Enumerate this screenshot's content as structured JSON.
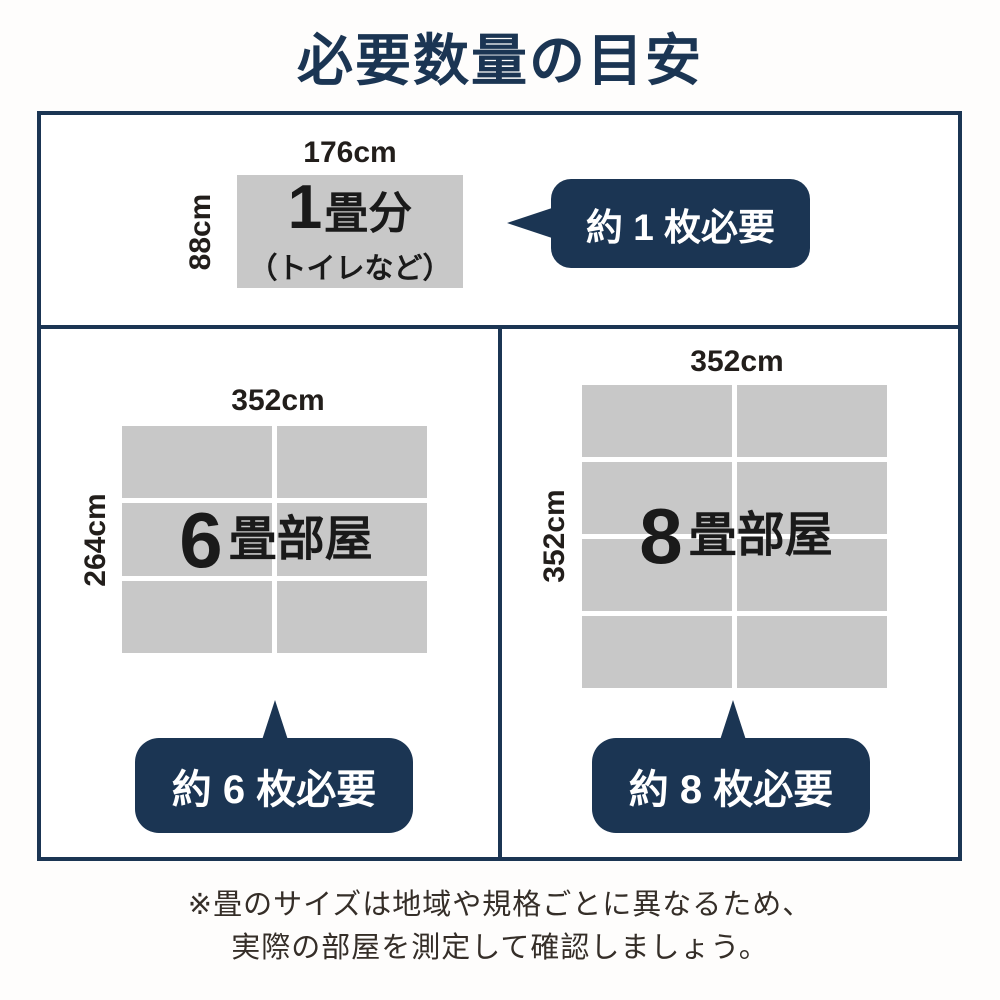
{
  "title": "必要数量の目安",
  "colors": {
    "navy": "#1b3553",
    "tatami_gray": "#c8c8c8",
    "text_dark": "#1a1a1a",
    "footnote_text": "#352e28"
  },
  "one_tatami": {
    "top_dim": "176cm",
    "side_dim": "88cm",
    "big_num": "1",
    "suffix": "畳分",
    "sub_label": "（トイレなど）",
    "bubble": "約 1 枚必要"
  },
  "six_tatami": {
    "top_dim": "352cm",
    "side_dim": "264cm",
    "big_num": "6",
    "suffix": "畳部屋",
    "bubble": "約 6 枚必要",
    "grid": {
      "rows": 3,
      "cols": 2
    }
  },
  "eight_tatami": {
    "top_dim": "352cm",
    "side_dim": "352cm",
    "big_num": "8",
    "suffix": "畳部屋",
    "bubble": "約 8 枚必要",
    "grid": {
      "rows": 4,
      "cols": 2
    }
  },
  "footnote": {
    "line1": "※畳のサイズは地域や規格ごとに異なるため、",
    "line2": "実際の部屋を測定して確認しましょう。"
  }
}
